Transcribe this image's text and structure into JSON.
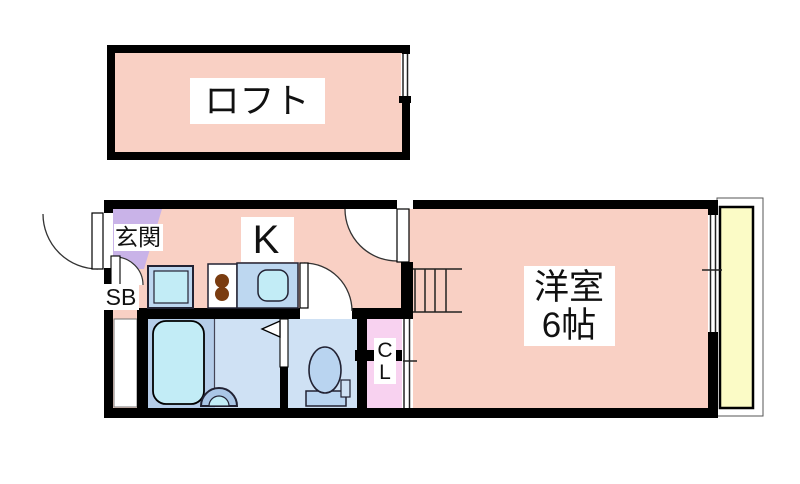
{
  "floorplan": {
    "loft": {
      "label": "ロフト"
    },
    "main": {
      "entrance_label": "玄関",
      "shoebox_label": "SB",
      "kitchen_label": "K",
      "closet_letters": [
        "C",
        "L"
      ],
      "room_label_line1": "洋室",
      "room_label_line2": "6帖"
    },
    "colors": {
      "wall": "#000000",
      "room_fill": "#f9d0c4",
      "entrance_fill": "#c9b3e8",
      "closet_fill": "#f8d2f0",
      "bath_zone_fill": "#b5cde9",
      "washroom_fill": "#cfe1f4",
      "fixture_cyan": "#c2ecf6",
      "counter_blue": "#bdd7f0",
      "toilet_blue": "#b9d4f0",
      "basin_blue": "#aac6e6",
      "balcony_fill": "#fbfbc6",
      "burner_brown": "#7a3c10"
    }
  }
}
